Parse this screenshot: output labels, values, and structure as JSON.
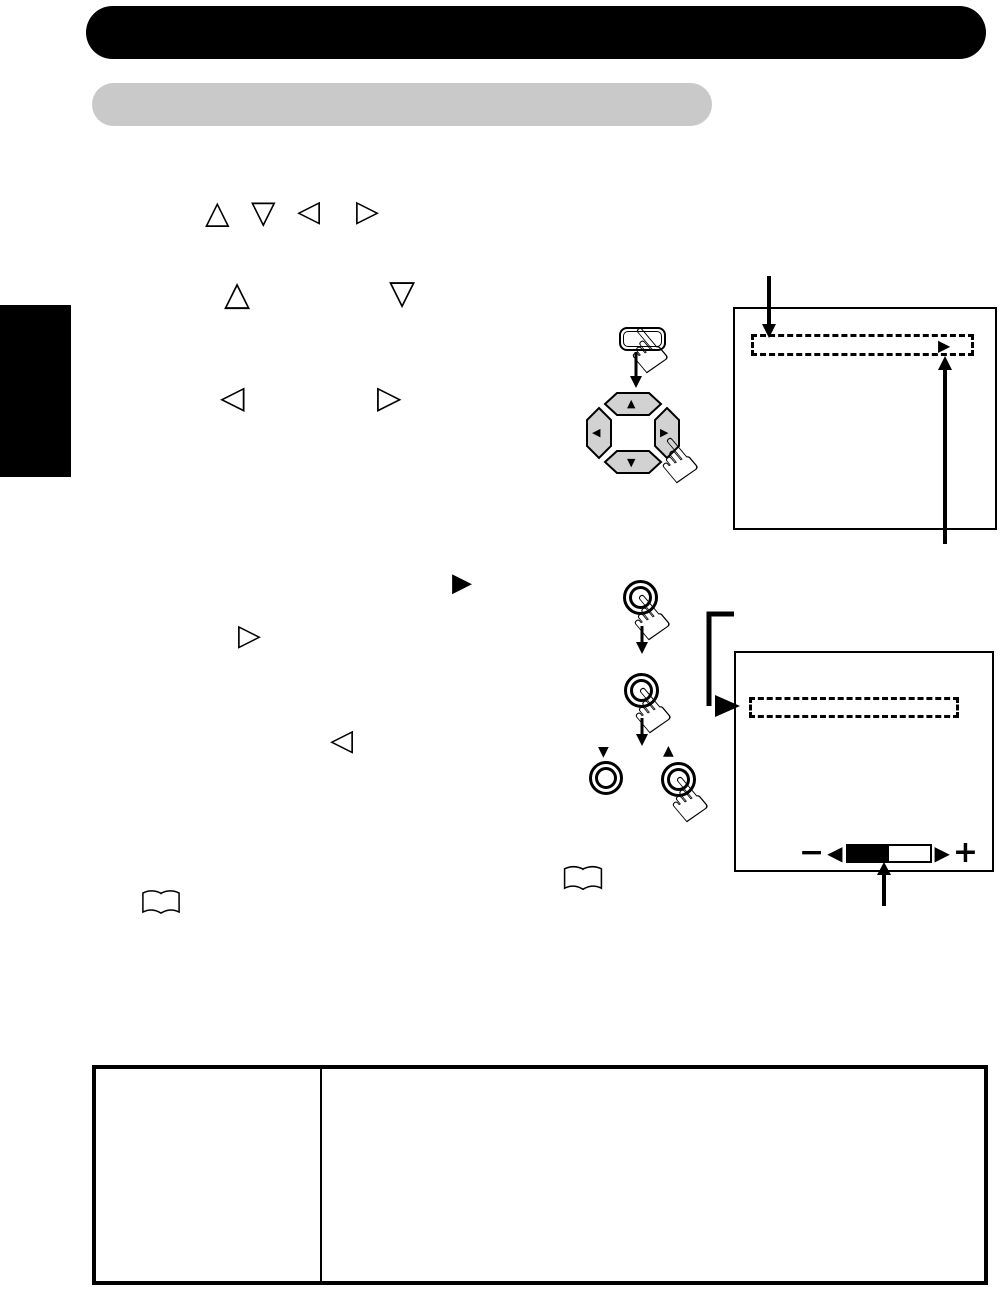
{
  "document": {
    "kind": "operating-instructions-page",
    "note": "scanned manual page with illustration-only content (no printed text visible)"
  },
  "colors": {
    "page_background": "#ffffff",
    "header_bar": "#000000",
    "section_bar": "#c9c9c9",
    "side_tab": "#000000",
    "line_art": "#000000",
    "dpad_button_fill": "#d2d2d2",
    "slider_fill": "#000000"
  },
  "key_icons": {
    "up_outline": "△",
    "down_outline": "▽",
    "left_outline": "◁",
    "right_outline": "▷",
    "right_solid": "▶"
  },
  "pointer_hand": "☝",
  "dpad": {
    "up": "▲",
    "down": "▼",
    "left": "◀",
    "right": "▶"
  },
  "sequence": {
    "step_down_marker": "▼",
    "step_up_marker": "▲"
  },
  "screen1": {
    "selection_cursor": "▶"
  },
  "screen2": {
    "slider": {
      "minus": "−",
      "plus": "+",
      "decrease": "◀",
      "increase": "▶",
      "fill_percent": 50,
      "fill_style": "width:50%"
    }
  }
}
